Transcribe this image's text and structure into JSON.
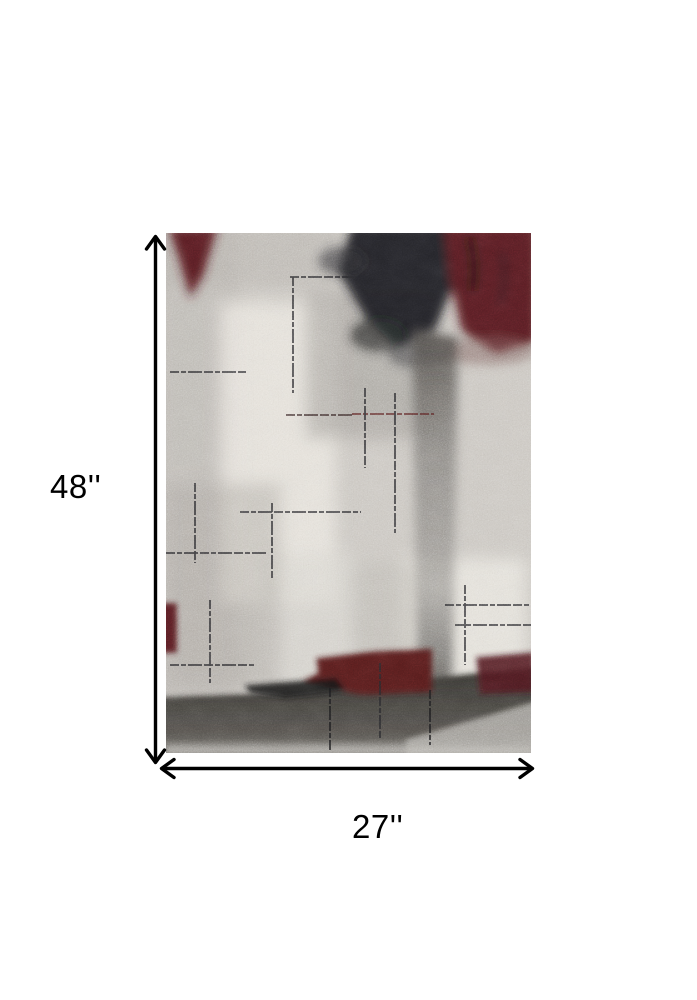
{
  "page": {
    "background_color": "#ffffff"
  },
  "dimension_annotation": {
    "height_label": "48''",
    "width_label": "27''",
    "height_value_inches": 48,
    "width_value_inches": 27,
    "arrow_color": "#000000"
  },
  "product_image": {
    "description": "Abstract distressed area rug: light gray and ivory ground with mottled texture, charcoal black mass at top center, burgundy red patches at top left, top right, lower center and lower right, thin dark cross-hatch scratch lines, a vertical gray streak down the middle right, and a dark charcoal band across the bottom fading to light gray at the bottom edge",
    "palette": {
      "base_gray": "#cdc9c3",
      "ivory_highlight": "#ebe8e1",
      "charcoal_black": "#1d1f22",
      "burgundy_red": "#571a20",
      "streak_gray": "#7d7a76",
      "bottom_band_dark": "#3a3834"
    }
  }
}
